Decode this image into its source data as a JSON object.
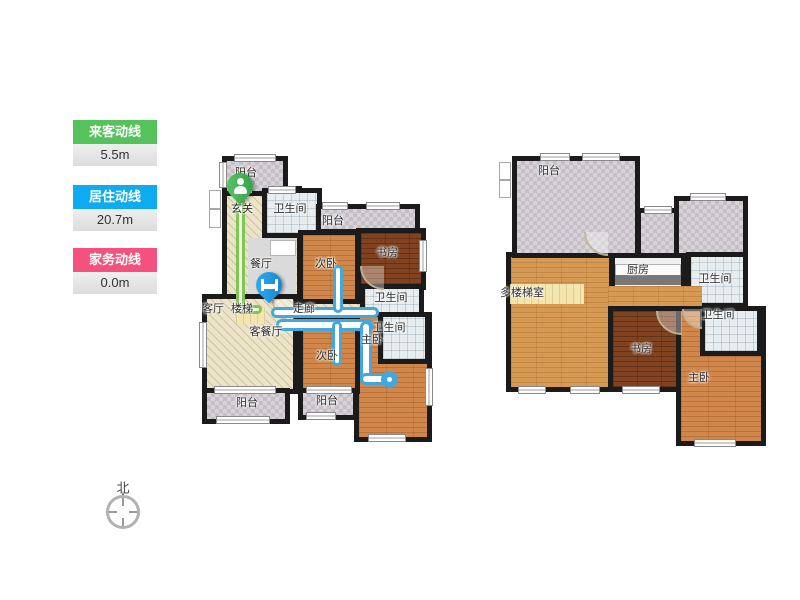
{
  "legend": {
    "items": [
      {
        "label": "来客动线",
        "value": "5.5m",
        "color": "#55c25b"
      },
      {
        "label": "居住动线",
        "value": "20.7m",
        "color": "#0fabf0"
      },
      {
        "label": "家务动线",
        "value": "0.0m",
        "color": "#f4517e"
      }
    ]
  },
  "compass": {
    "north_label": "北"
  },
  "floor1": {
    "labels": [
      "阳台",
      "玄关",
      "卫生间",
      "阳台",
      "餐厅",
      "次卧",
      "书房",
      "卫生间",
      "客厅",
      "楼梯",
      "走廊",
      "客餐厅",
      "次卧",
      "主卧",
      "卫生间",
      "阳台",
      "阳台"
    ]
  },
  "floor2": {
    "labels": [
      "阳台",
      "厨房",
      "卫生间",
      "多楼梯室",
      "卫生间",
      "书房",
      "主卧"
    ]
  },
  "markers": {
    "visitor_start_icon": "person-icon",
    "resident_start_icon": "bed-icon"
  },
  "route_colors": {
    "visitor": "#82c455",
    "resident": "#43a7de"
  }
}
